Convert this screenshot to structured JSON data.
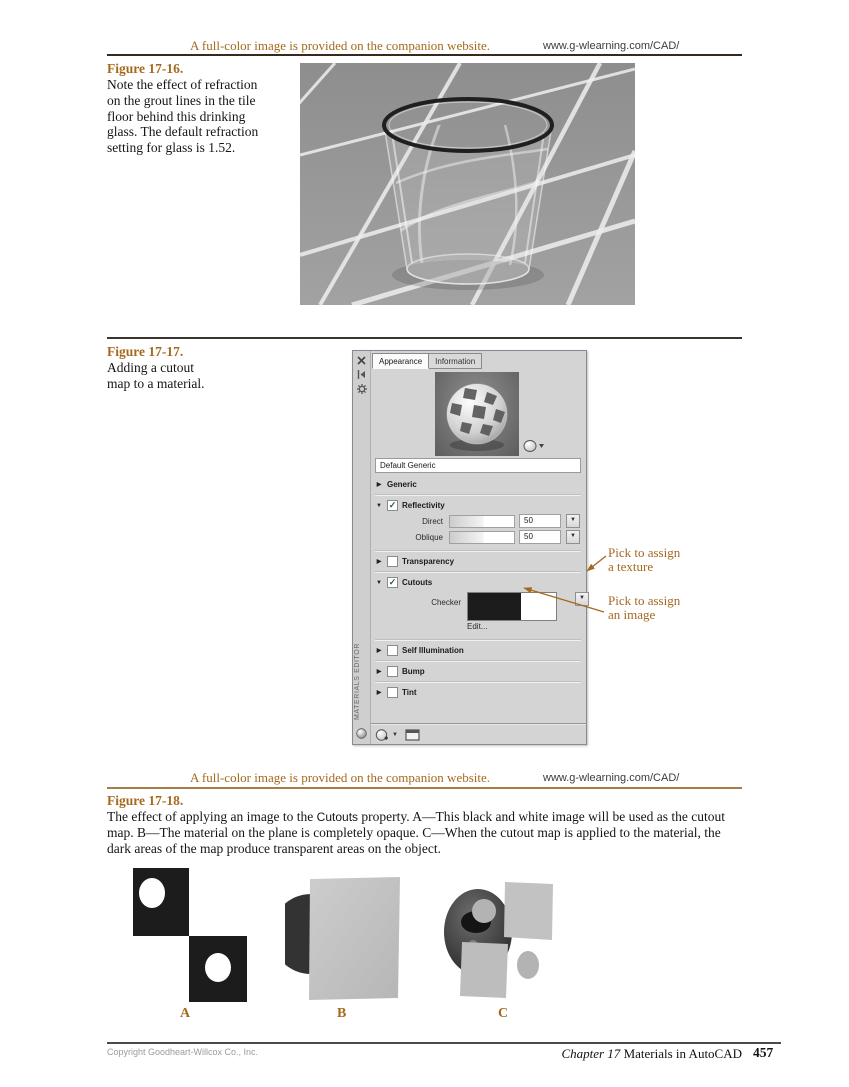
{
  "banner": {
    "notice": "A full-color image is provided on the companion website.",
    "url": "www.g-wlearning.com/CAD/"
  },
  "figures": {
    "fig16": {
      "label": "Figure 17-16.",
      "caption": "Note the effect of refraction on the grout lines in the tile floor behind this drinking glass. The default refraction setting for glass is 1.52."
    },
    "fig17": {
      "label": "Figure 17-17.",
      "caption_line1": "Adding a cutout",
      "caption_line2": "map to a material."
    },
    "fig18": {
      "label": "Figure 17-18.",
      "caption_before": "The effect of applying an image to the ",
      "caption_ui_term": "Cutouts",
      "caption_after": " property. A—This black and white image will be used as the cutout map. B—The material on the plane is completely opaque. C—When the cutout map is applied to the material, the dark areas of the map produce transparent areas on the object.",
      "image_labels": [
        "A",
        "B",
        "C"
      ]
    }
  },
  "annotations": {
    "texture_line1": "Pick to assign",
    "texture_line2": "a texture",
    "image_line1": "Pick to assign",
    "image_line2": "an image"
  },
  "editor": {
    "tabs": [
      {
        "label": "Appearance",
        "active": true
      },
      {
        "label": "Information",
        "active": false
      }
    ],
    "name_field_value": "Default Generic",
    "vertical_title": "MATERIALS EDITOR",
    "sections": {
      "generic": {
        "label": "Generic"
      },
      "reflectivity": {
        "label": "Reflectivity",
        "direct_label": "Direct",
        "direct_value": "50",
        "oblique_label": "Oblique",
        "oblique_value": "50"
      },
      "transparency": {
        "label": "Transparency"
      },
      "cutouts": {
        "label": "Cutouts",
        "map_label": "Checker",
        "edit_label": "Edit..."
      },
      "self_illumination": {
        "label": "Self Illumination"
      },
      "bump": {
        "label": "Bump"
      },
      "tint": {
        "label": "Tint"
      }
    }
  },
  "footer": {
    "copyright": "Copyright Goodheart-Willcox Co., Inc.",
    "chapter": "Chapter 17",
    "chapter_title": "Materials in AutoCAD",
    "page_number": "457"
  },
  "colors": {
    "accent_brown": "#a5691e",
    "rule_dark": "#38291c",
    "rule_brown": "#a87c45",
    "checker_black": "#1c1c1c"
  }
}
